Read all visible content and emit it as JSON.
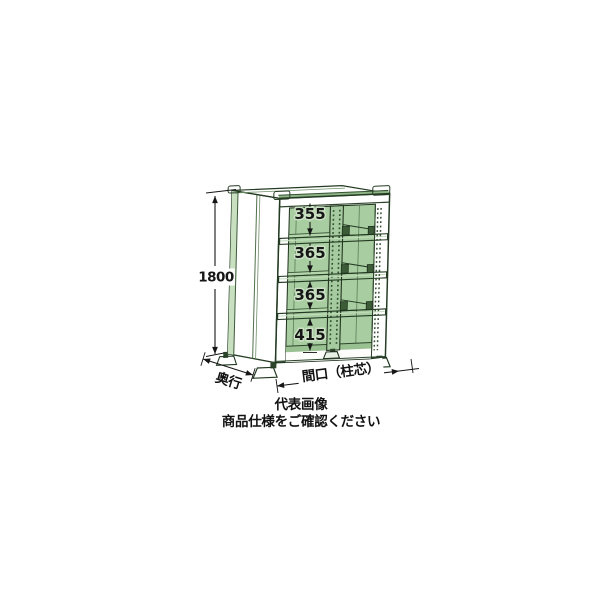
{
  "image": {
    "subject": "steel shelving rack product illustration with dimension callouts",
    "dimensions": {
      "height": "1800",
      "compartments": [
        "355",
        "365",
        "365",
        "415"
      ],
      "depth_label": "奥行",
      "width_label": "間口（柱芯）"
    },
    "caption": {
      "line1": "代表画像",
      "line2": "商品仕様をご確認ください"
    },
    "colors": {
      "body_green": "#a2c89c",
      "top_green": "#abd0a3",
      "interior_green": "#a8cda1",
      "shelf_light_green": "#b4d6ab",
      "dark_shade_green": "#8fb586",
      "outline_dark": "#243b23",
      "dimension_ink": "#161616",
      "background": "#ffffff"
    }
  }
}
